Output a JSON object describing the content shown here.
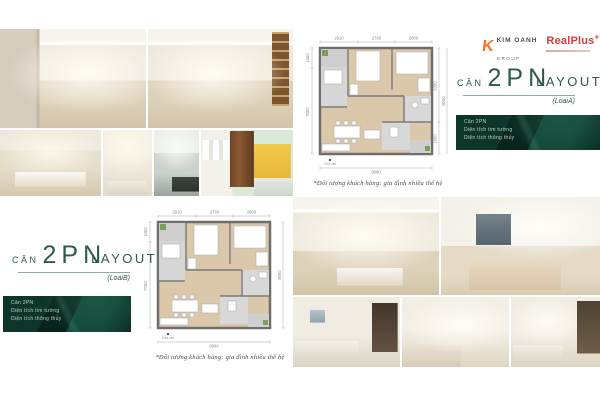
{
  "colors": {
    "title_green": "#2d5b4f",
    "info_box_green": "#0c2f25",
    "kim_oanh_orange": "#ee7623",
    "realplus_red": "#d93a3e",
    "plan_wood": "#dbc7aa",
    "plan_wall": "#6e6e6e"
  },
  "brand": {
    "kim_oanh": {
      "mark": "K",
      "name": "KIM OANH",
      "sub": "GROUP"
    },
    "realplus": {
      "name": "RealPlus",
      "plus": "+"
    }
  },
  "section_a": {
    "title": {
      "prefix": "CĂN",
      "big": "2PN",
      "suffix": "LAYOUT",
      "variant": "(LoaiA)"
    },
    "info": {
      "lines": [
        "Căn 2PN",
        "Diện tích tim tường",
        "Diện tích thông thủy"
      ]
    },
    "plan": {
      "dims_top": [
        "2910",
        "2760",
        "2800"
      ],
      "dims_left": [
        "1400",
        "7050"
      ],
      "dims_right": [
        "6390",
        "8050",
        "1660"
      ],
      "dim_bottom": "8990",
      "entry_label": "Cửa vào",
      "caption": "*Đối tượng khách hàng: gia đình nhiều thế hệ"
    }
  },
  "section_b": {
    "title": {
      "prefix": "CĂN",
      "big": "2PN",
      "suffix": "LAYOUT",
      "variant": "(LoaiB)"
    },
    "info": {
      "lines": [
        "Căn 2PN",
        "Diện tích tim tường",
        "Diện tích thông thủy"
      ]
    },
    "plan": {
      "dims_top": [
        "2910",
        "2760",
        "2800"
      ],
      "dims_left": [
        "1000",
        "7050"
      ],
      "dims_right": [
        "",
        "8050",
        ""
      ],
      "dim_bottom": "8990",
      "entry_label": "Cửa vào",
      "caption": "*Đối tượng khách hàng: gia đình nhiều thế hệ"
    }
  },
  "photos": {
    "top_grid": [
      "hallway-dining-room",
      "living-dining-room",
      "dining-area",
      "living-room-pendant",
      "bathroom",
      "kids-bedroom"
    ],
    "bottom_grid": [
      "living-dining-room",
      "master-bedroom-window",
      "sofa-living-room",
      "hallway-sofa",
      "living-room-tv-shelf"
    ]
  }
}
